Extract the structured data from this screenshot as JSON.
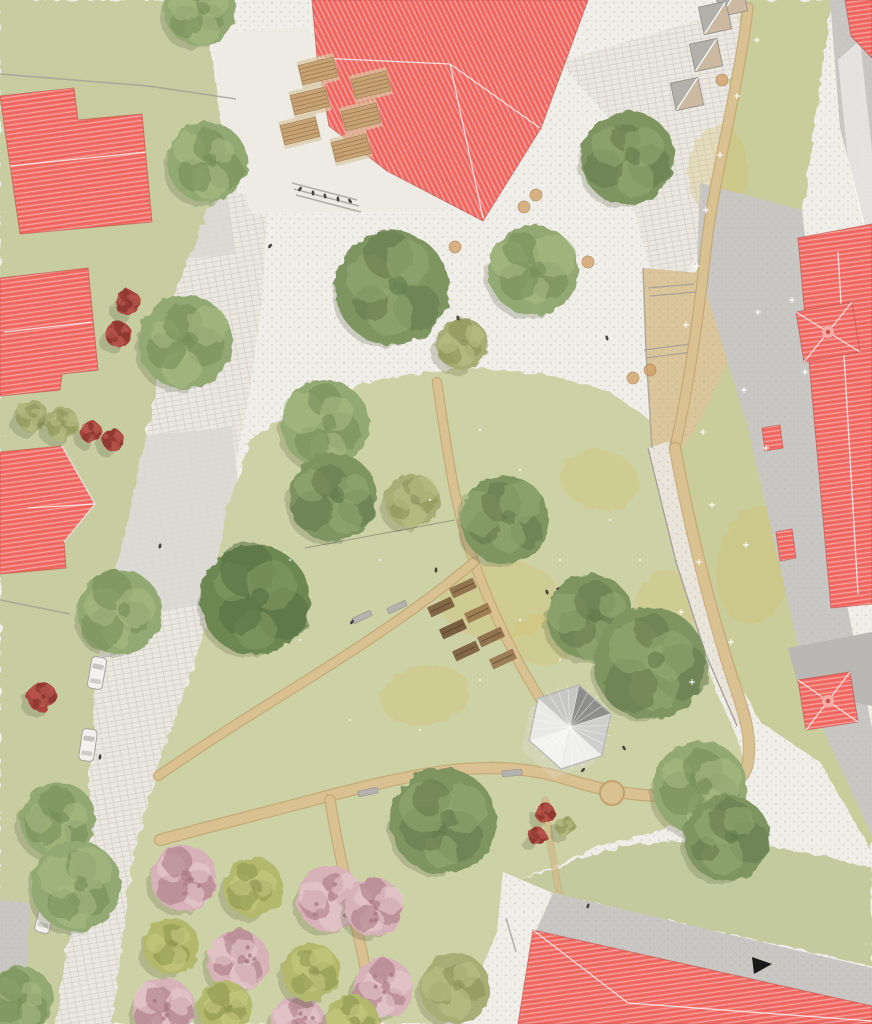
{
  "meta": {
    "description": "aerial-landscape-masterplan-site-rendering",
    "canvas": {
      "w": 872,
      "h": 1024
    }
  },
  "palette": {
    "plaza_white": "#f0eee8",
    "road_white": "#ebe8e1",
    "market_white": "#edebe4",
    "speck_dot": "#a9a49a",
    "courtyard_gray": "#d9d7d1",
    "walk_gray": "#c8c7c3",
    "walk_gray2": "#d0cfcb",
    "roof_gray": "#b9b8b4",
    "roof_red": "#f36e67",
    "roof_red_line": "#ffffff",
    "sand": "#dbc69c",
    "gravel": "#e9e5da",
    "path_fill": "#d9c192",
    "path_edge": "#c2a26e",
    "wall": "#a29e97",
    "lawn_left": "#c7cda0",
    "lawn_park": "#cdd2a6",
    "lawn_meadow": "#c9cd9c",
    "lawn_br": "#c3cb9e",
    "patch_yellow": "#d7be64",
    "tree_mid": "#93a973",
    "tree_mid_hi": "#aabb85",
    "tree_mid_dk": "#748c58",
    "tree_deep": "#7e9562",
    "tree_deep_hi": "#96ab74",
    "tree_deep_dk": "#62794b",
    "tree_dark": "#6d8753",
    "tree_dark_hi": "#859c66",
    "tree_dark_dk": "#566e42",
    "tree_olive": "#a6ad74",
    "tree_olive_hi": "#bcc287",
    "tree_olive_dk": "#8a9158",
    "cherry": "#d8b2b9",
    "cherry_hi": "#e8cdd2",
    "cherry_dk": "#a87680",
    "orchard_green": "#b2b96d",
    "orchard_green_hi": "#c6cc83",
    "orchard_green_dk": "#8c934c",
    "bush_red": "#a8443c",
    "bush_red_dk": "#7c2f2a",
    "table_wood": "#c7a374",
    "table_plank": "#8f6f4e",
    "bench_gray": "#b4b2ad",
    "car_body": "#f2f1ee",
    "car_line": "#a5a29c",
    "person": "#45433f",
    "pavilion_light": "#efefed",
    "pavilion_dark": "#8e8e8c",
    "marker_black": "#1a1a1a"
  },
  "scene": {
    "lawns": [
      {
        "name": "lawn-left-strip",
        "points": "0,0 205,0 212,60 222,130 215,192 175,290 150,420 118,560 95,680 88,800 70,930 55,1024 0,1024",
        "fill": "#c7cda0"
      },
      {
        "name": "lawn-central-park",
        "points": "250,440 310,400 380,380 460,368 545,374 610,392 650,420 668,478 690,590 712,680 740,745 748,792 700,820 600,846 520,880 505,950 497,1024 112,1024 122,940 133,855 162,755 190,675 205,630 228,505",
        "fill": "#cdd2a6"
      },
      {
        "name": "lawn-right-meadow",
        "points": "745,0 832,0 802,215 820,420 845,610 872,770 872,852 820,762 760,722 716,640 690,540 668,440 680,350 700,250 725,120",
        "fill": "#c9cd9c"
      },
      {
        "name": "lawn-bottom-right",
        "points": "520,880 620,846 720,838 820,855 872,868 872,966 552,894",
        "fill": "#c3cb9e"
      },
      {
        "name": "lawn-top-right-corner",
        "points": "852,70 872,58 872,165",
        "fill": "#c9cd9c"
      }
    ],
    "roads": [
      {
        "name": "main-street-west",
        "points": "215,192 268,195 262,300 250,390 228,505 205,630 190,675 162,755 133,855 125,930 112,1024 55,1024 70,930 88,800 95,680 118,560 150,420 175,290"
      },
      {
        "name": "street-north-east",
        "points": "560,62 763,0 740,128 704,240 667,312 648,262 610,120"
      }
    ],
    "market_plaza": {
      "name": "market-plaza",
      "points": "214,34 308,26 318,60 330,126 388,172 445,198 448,210 252,214 222,130",
      "fill": "#edebe4"
    },
    "courtyards": [
      {
        "name": "courtyard-north-west",
        "points": "84,100 212,88 236,254 106,266"
      },
      {
        "name": "courtyard-west",
        "points": "58,444 232,427 250,598 80,622"
      }
    ],
    "gray_walks": [
      {
        "name": "walkway-east-band",
        "points": "700,183 802,210 846,600 872,728 872,836 812,706 748,428 697,262"
      },
      {
        "name": "walkway-north-east",
        "points": "830,0 858,0 872,36 872,252 840,128"
      },
      {
        "name": "wall-strip-south-west",
        "points": "0,900 30,903 26,978 0,974"
      }
    ],
    "walk_highlight": {
      "points": "838,60 860,40 872,150 872,262 848,162",
      "fill": "rgba(255,255,255,0.5)"
    },
    "plaza_strip_south": {
      "name": "plaza-strip-south-east",
      "points": "503,872 553,893 537,932 518,1024 458,1024 497,932"
    },
    "sand_area": {
      "name": "sand-play-area",
      "points": "643,268 757,278 737,338 702,418 670,466 652,448 646,352",
      "steps": [
        "648,288 694,284",
        "650,296 696,292",
        "644,350 690,344",
        "646,358 692,352"
      ]
    },
    "gravel_band": {
      "name": "gravel-wall-band",
      "points": "648,448 670,441 702,560 726,652 750,716 737,726 706,655 676,562",
      "edges": [
        "648,448 676,562 706,655 737,726",
        "670,441 702,560 726,652 750,716"
      ]
    },
    "paths": [
      {
        "name": "path-meadow-edge",
        "d": "M748,8 C738,90 716,170 707,240 C699,315 689,385 675,448",
        "w": 9
      },
      {
        "name": "path-park-loop",
        "d": "M675,448 C688,520 710,610 733,680 C744,712 752,736 748,762 C744,788 712,796 668,796 C630,796 600,790 560,777 C520,766 480,766 438,772 C390,779 340,793 290,806 C240,819 200,829 160,840",
        "w": 10
      },
      {
        "name": "path-center-north",
        "d": "M437,382 C447,450 455,510 474,562 C490,606 512,655 544,705 C552,717 558,728 561,740",
        "w": 8
      },
      {
        "name": "path-center-west",
        "d": "M474,562 C430,600 370,640 310,678 C265,706 210,740 158,776",
        "w": 8
      },
      {
        "name": "path-orchard-east",
        "d": "M330,800 C338,852 352,906 362,952 C368,982 372,1004 375,1024",
        "w": 9
      },
      {
        "name": "path-faint-south",
        "d": "M545,800 C550,845 556,878 562,905",
        "w": 5,
        "faint": true
      }
    ],
    "path_bulge": {
      "cx": 612,
      "cy": 793,
      "r": 12
    },
    "walls": [
      "0,74 148,86",
      "148,86 236,99",
      "0,600 70,614",
      "506,918 516,952",
      "643,268 646,352 652,448",
      "292,183 357,200",
      "294,189 359,206",
      "296,195 361,212"
    ],
    "slackline": {
      "x1": 305,
      "y1": 548,
      "x2": 455,
      "y2": 520
    },
    "buildings_red": [
      {
        "name": "building-school-north",
        "points": "312,0 588,0 541,128 483,221 387,171 329,126 317,58",
        "stripe": "d",
        "ridges": [
          "318,58 450,64",
          "450,64 483,218",
          "450,64 540,128"
        ]
      },
      {
        "name": "building-west-1",
        "points": "0,96 74,88 78,120 142,114 152,222 20,234",
        "stripe": "h",
        "ridges": [
          "10,166 146,152"
        ]
      },
      {
        "name": "building-west-2",
        "points": "0,278 88,268 98,370 62,374 60,390 0,396",
        "stripe": "h",
        "ridges": [
          "4,332 92,322"
        ]
      },
      {
        "name": "building-west-3",
        "points": "0,452 62,446 95,504 64,542 66,568 0,574",
        "stripe": "h",
        "ridges": [
          "95,504 28,508",
          "62,446 95,504",
          "64,542 95,504"
        ]
      },
      {
        "name": "building-east-long",
        "points": "798,238 872,224 872,604 831,608",
        "stripe": "h",
        "ridges": [
          "838,252 858,594"
        ]
      },
      {
        "name": "building-east-tower",
        "points": "796,312 852,302 860,352 804,362",
        "stripe": "h",
        "ridges": [
          "796,312 828,332",
          "852,302 828,332",
          "860,352 828,332",
          "804,362 828,332"
        ],
        "finial": [
          828,
          332
        ]
      },
      {
        "name": "building-east-annex-1",
        "points": "762,428 780,425 783,448 765,451",
        "stripe": "h",
        "ridges": []
      },
      {
        "name": "building-east-annex-2",
        "points": "776,532 792,529 796,558 780,561",
        "stripe": "h",
        "ridges": []
      },
      {
        "name": "building-south-east-tower",
        "points": "798,680 850,672 858,722 806,730",
        "stripe": "h",
        "ridges": [
          "798,680 828,701",
          "850,672 828,701",
          "858,722 828,701",
          "806,730 828,701"
        ],
        "finial": [
          828,
          701
        ]
      },
      {
        "name": "building-south",
        "points": "533,930 872,1006 872,1024 518,1024",
        "stripe": "h",
        "ridges": [
          "533,930 628,1003",
          "628,1003 872,1021"
        ]
      },
      {
        "name": "building-north-east-corner",
        "points": "845,0 872,0 872,58 851,36",
        "stripe": "h",
        "ridges": []
      }
    ],
    "buildings_gray": [
      {
        "name": "roof-gray-south-band",
        "points": "553,893 872,968 872,1008 536,931",
        "fill": "#c8c7c3",
        "speck": true
      },
      {
        "name": "roof-gray-east-wing",
        "points": "788,648 872,632 872,706 800,692",
        "fill": "#b9b8b4"
      }
    ],
    "market_tables": {
      "size": [
        36,
        20
      ],
      "rot": -14,
      "centers": [
        [
          318,
          71
        ],
        [
          371,
          85
        ],
        [
          310,
          101
        ],
        [
          361,
          117
        ],
        [
          300,
          131
        ],
        [
          351,
          148
        ]
      ]
    },
    "stalls": {
      "size": 28,
      "rot": -12,
      "centers": [
        [
          731,
          0
        ],
        [
          715,
          18
        ],
        [
          706,
          55
        ],
        [
          687,
          94
        ]
      ]
    },
    "cars": [
      {
        "x": 97,
        "y": 673,
        "rot": 10
      },
      {
        "x": 88,
        "y": 745,
        "rot": 8
      },
      {
        "x": 45,
        "y": 917,
        "rot": 14
      }
    ],
    "garden_beds": {
      "size": [
        26,
        11
      ],
      "rot": -25,
      "items": [
        [
          463,
          588
        ],
        [
          441,
          607
        ],
        [
          478,
          613
        ],
        [
          453,
          629
        ],
        [
          491,
          637
        ],
        [
          466,
          651
        ],
        [
          503,
          659
        ]
      ],
      "fills": [
        "#8a6a48",
        "#7a5b3c",
        "#97764f",
        "#6f5236",
        "#8a6a48",
        "#7a5b3c",
        "#97764f"
      ],
      "table": {
        "x": 564,
        "y": 589,
        "w": 14,
        "h": 8,
        "rot": -25,
        "fill": "#57524a"
      }
    },
    "benches": [
      {
        "x": 362,
        "y": 617,
        "rot": -25
      },
      {
        "x": 397,
        "y": 607,
        "rot": -25
      },
      {
        "x": 368,
        "y": 792,
        "rot": -12
      },
      {
        "x": 512,
        "y": 773,
        "rot": -5
      }
    ],
    "pavilion": {
      "cx": 570,
      "cy": 727,
      "r": 43,
      "rot": 12,
      "segment_fills": [
        "#8e8e8c",
        "#cfcfcd",
        "#efefed",
        "#f3f3f1",
        "#e9e9e7",
        "#c7c7c5"
      ]
    },
    "trees": [
      {
        "x": 200,
        "y": 10,
        "r": 36,
        "k": "mid"
      },
      {
        "x": 207,
        "y": 162,
        "r": 40,
        "k": "mid"
      },
      {
        "x": 628,
        "y": 158,
        "r": 47,
        "k": "deep"
      },
      {
        "x": 185,
        "y": 342,
        "r": 47,
        "k": "mid"
      },
      {
        "x": 392,
        "y": 288,
        "r": 57,
        "k": "deep"
      },
      {
        "x": 533,
        "y": 270,
        "r": 45,
        "k": "mid"
      },
      {
        "x": 462,
        "y": 344,
        "r": 26,
        "k": "olive"
      },
      {
        "x": 325,
        "y": 424,
        "r": 44,
        "k": "mid"
      },
      {
        "x": 333,
        "y": 497,
        "r": 44,
        "k": "deep"
      },
      {
        "x": 412,
        "y": 501,
        "r": 27,
        "k": "olive"
      },
      {
        "x": 255,
        "y": 600,
        "r": 55,
        "k": "dark"
      },
      {
        "x": 505,
        "y": 520,
        "r": 44,
        "k": "deep"
      },
      {
        "x": 120,
        "y": 612,
        "r": 42,
        "k": "mid"
      },
      {
        "x": 590,
        "y": 617,
        "r": 43,
        "k": "deep"
      },
      {
        "x": 650,
        "y": 663,
        "r": 56,
        "k": "deep"
      },
      {
        "x": 700,
        "y": 788,
        "r": 47,
        "k": "mid"
      },
      {
        "x": 727,
        "y": 838,
        "r": 43,
        "k": "deep"
      },
      {
        "x": 443,
        "y": 821,
        "r": 53,
        "k": "deep"
      },
      {
        "x": 58,
        "y": 820,
        "r": 38,
        "k": "mid"
      },
      {
        "x": 76,
        "y": 886,
        "r": 45,
        "k": "mid"
      },
      {
        "x": 20,
        "y": 1000,
        "r": 34,
        "k": "mid"
      },
      {
        "x": 455,
        "y": 988,
        "r": 35,
        "k": "olive"
      }
    ],
    "orchard_pink": [
      [
        184,
        878,
        33
      ],
      [
        330,
        899,
        33
      ],
      [
        374,
        907,
        29
      ],
      [
        238,
        961,
        31
      ],
      [
        164,
        1009,
        31
      ],
      [
        383,
        988,
        30
      ],
      [
        298,
        1024,
        28
      ]
    ],
    "orchard_green": [
      [
        253,
        887,
        30
      ],
      [
        171,
        946,
        28
      ],
      [
        311,
        972,
        29
      ],
      [
        225,
        1008,
        27
      ],
      [
        352,
        1022,
        27
      ]
    ],
    "bushes_red": [
      [
        42,
        697,
        15
      ],
      [
        128,
        303,
        13
      ],
      [
        118,
        334,
        13
      ],
      [
        91,
        432,
        11
      ],
      [
        113,
        440,
        11
      ],
      [
        545,
        813,
        10
      ],
      [
        537,
        836,
        9
      ]
    ],
    "bushes_green": [
      [
        565,
        826,
        10
      ],
      [
        32,
        416,
        16
      ],
      [
        62,
        424,
        17
      ]
    ],
    "meadow_flowers": [
      [
        757,
        40
      ],
      [
        737,
        96
      ],
      [
        720,
        155
      ],
      [
        706,
        210
      ],
      [
        697,
        266
      ],
      [
        686,
        325
      ],
      [
        758,
        312
      ],
      [
        792,
        300
      ],
      [
        744,
        390
      ],
      [
        703,
        432
      ],
      [
        712,
        505
      ],
      [
        746,
        545
      ],
      [
        699,
        562
      ],
      [
        681,
        612
      ],
      [
        731,
        642
      ],
      [
        692,
        682
      ],
      [
        766,
        448
      ],
      [
        805,
        372
      ]
    ],
    "park_flower_dots": [
      [
        480,
        430
      ],
      [
        520,
        470
      ],
      [
        430,
        500
      ],
      [
        560,
        560
      ],
      [
        610,
        520
      ],
      [
        380,
        560
      ],
      [
        300,
        640
      ],
      [
        480,
        680
      ],
      [
        420,
        730
      ],
      [
        350,
        720
      ],
      [
        560,
        660
      ],
      [
        640,
        560
      ],
      [
        520,
        620
      ],
      [
        290,
        560
      ]
    ],
    "yellow_patches": [
      [
        775,
        330,
        45,
        70
      ],
      [
        755,
        565,
        38,
        60
      ],
      [
        718,
        170,
        30,
        45
      ],
      [
        500,
        600,
        60,
        40
      ],
      [
        425,
        695,
        45,
        30
      ],
      [
        600,
        480,
        40,
        30
      ],
      [
        665,
        610,
        30,
        40
      ],
      [
        545,
        640,
        35,
        25
      ]
    ],
    "furniture_dots": [
      [
        455,
        247
      ],
      [
        524,
        207
      ],
      [
        588,
        262
      ],
      [
        633,
        378
      ],
      [
        650,
        370
      ],
      [
        722,
        80
      ],
      [
        536,
        195
      ]
    ],
    "people": [
      [
        300,
        189
      ],
      [
        313,
        193
      ],
      [
        325,
        196
      ],
      [
        338,
        199
      ],
      [
        350,
        201
      ],
      [
        270,
        246
      ],
      [
        458,
        318
      ],
      [
        607,
        338
      ],
      [
        160,
        546
      ],
      [
        100,
        757
      ],
      [
        436,
        570
      ],
      [
        547,
        592
      ],
      [
        352,
        622
      ],
      [
        583,
        770
      ],
      [
        624,
        748
      ],
      [
        588,
        906
      ]
    ],
    "north_marker": {
      "name": "north-arrow",
      "points": "752,957 772,964 754,974"
    }
  }
}
